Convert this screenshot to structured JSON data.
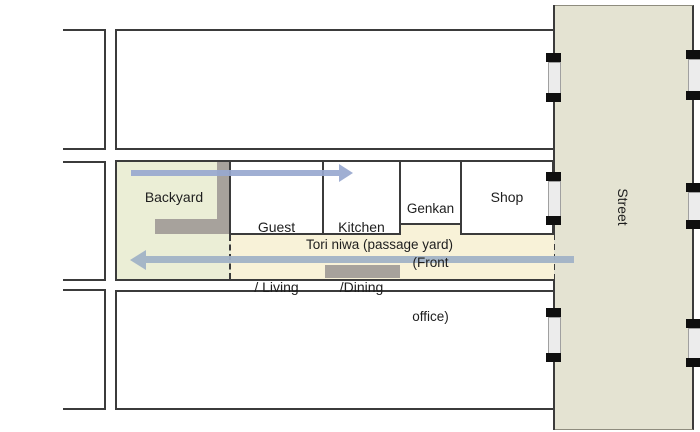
{
  "diagram": {
    "type": "floor-plan",
    "street": {
      "label": "Street"
    },
    "passage": {
      "label": "Tori niwa (passage yard)"
    },
    "rooms": {
      "backyard": {
        "label": "Backyard"
      },
      "guest_living": {
        "line1": "Guest",
        "line2": "/ Living"
      },
      "kitchen_dining": {
        "line1": "Kitchen",
        "line2": "/Dining"
      },
      "genkan": {
        "line1": "Genkan",
        "line2": "(Front",
        "line3": "office)"
      },
      "shop": {
        "label": "Shop"
      }
    },
    "arrows": {
      "inward": "right",
      "outward": "left"
    },
    "colors": {
      "outline": "#3b3b3b",
      "backyard_fill": "#ebeed6",
      "passage_fill": "#f8f2d8",
      "street_fill": "#e4e3d2",
      "gray_block": "#a7a29c",
      "arrow_in_blue": "#98a8cf",
      "arrow_out_blue": "#a1b2c6",
      "door_tick": "#0f0f0f",
      "door_panel": "#ececec"
    }
  }
}
